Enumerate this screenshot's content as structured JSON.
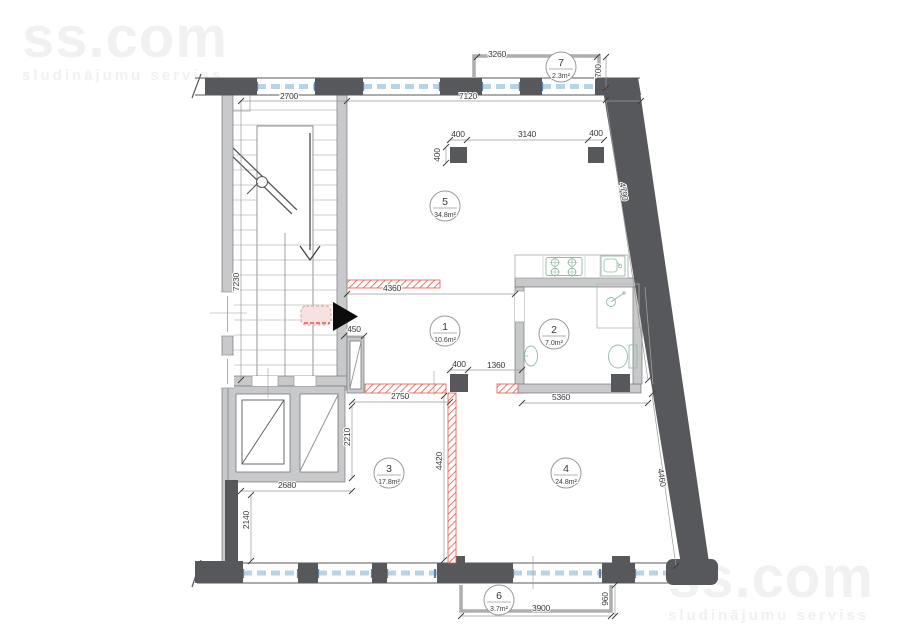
{
  "watermark": {
    "brand": "ss.com",
    "tagline": "sludinājumu serviss"
  },
  "rooms": [
    {
      "number": "1",
      "area": "10.6m²"
    },
    {
      "number": "2",
      "area": "7.0m²"
    },
    {
      "number": "3",
      "area": "17.8m²"
    },
    {
      "number": "4",
      "area": "24.8m²"
    },
    {
      "number": "5",
      "area": "34.8m²"
    },
    {
      "number": "6",
      "area": "3.7m²"
    },
    {
      "number": "7",
      "area": "2.3m²"
    }
  ],
  "dims": {
    "d3260": "3260",
    "d700": "700",
    "d2700": "2700",
    "d7120": "7120",
    "d400_col_left": "400",
    "d3140": "3140",
    "d400_col_right": "400",
    "d400_col_side": "400",
    "d4790": "4790",
    "d7230": "7230",
    "d4360": "4360",
    "d450": "450",
    "d400_col_mid": "400",
    "d1360": "1360",
    "d2750": "2750",
    "d5360": "5360",
    "d2210": "2210",
    "d4420": "4420",
    "d2680": "2680",
    "d2140": "2140",
    "d4460": "4460",
    "d3900": "3900",
    "d960": "960"
  },
  "colors": {
    "wall_dark": "#57585c",
    "wall_light": "#c8c9cb",
    "demolition_red": "#e2574c",
    "window_blue": "#b8d3e6",
    "window_cap_blue": "#5b7fa6",
    "fixture_green": "#93bba6",
    "watermark_gray": "#f1f1f2"
  }
}
